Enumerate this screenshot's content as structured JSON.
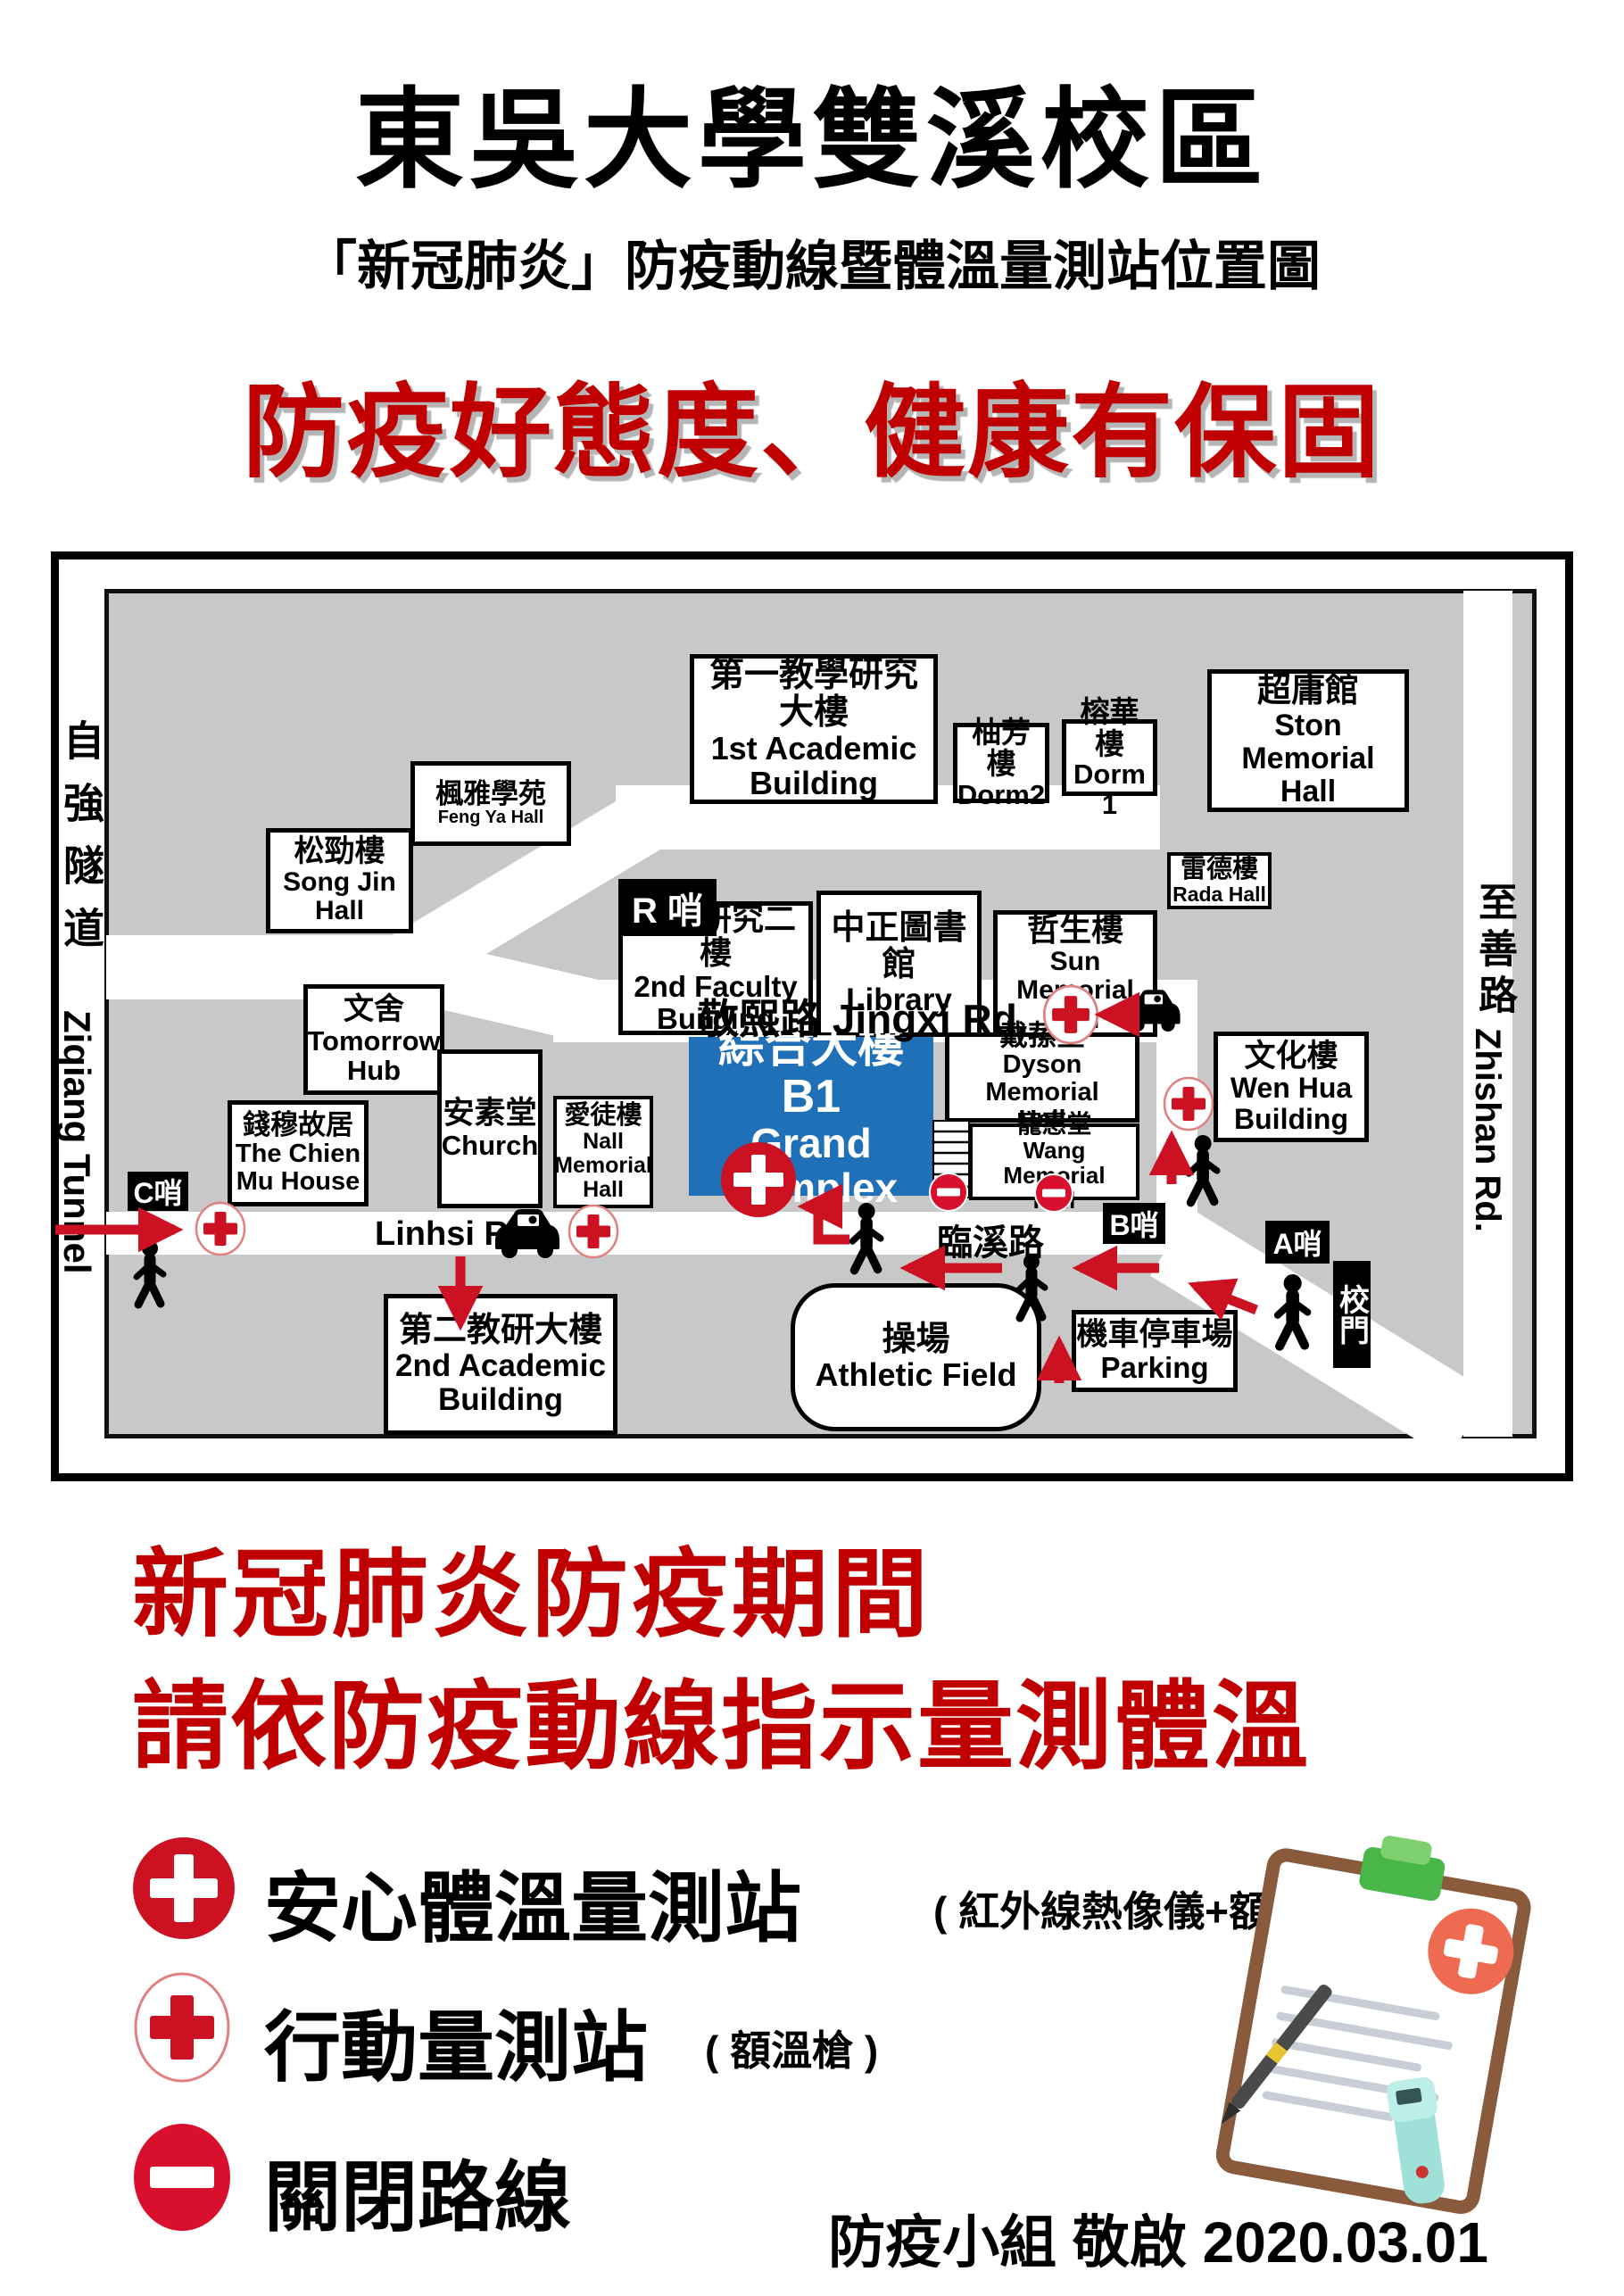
{
  "header": {
    "title": "東吳大學雙溪校區",
    "subtitle": "「新冠肺炎」防疫動線暨體溫量測站位置圖",
    "slogan": "防疫好態度、健康有保固"
  },
  "map": {
    "tunnel_zh": "自強隧道",
    "tunnel_en": "Ziqiang Tunnel",
    "zhishan_zh": "至善路",
    "zhishan_en": "Zhishan Rd.",
    "jingxi_label": "敬熙路 Jingxi Rd.",
    "linhsi_zh": "臨溪路",
    "linhsi_en": "Linhsi Rd.",
    "checkpoints": {
      "r": "R 哨",
      "c": "C哨",
      "b": "B哨",
      "a": "A哨",
      "gate": "校門"
    },
    "buildings": {
      "feng_ya": {
        "zh": "楓雅學苑",
        "en1": "Feng Ya Hall"
      },
      "song_jin": {
        "zh": "松勁樓",
        "en1": "Song Jin",
        "en2": "Hall"
      },
      "academic1": {
        "zh": "第一教學研究大樓",
        "en1": "1st Academic",
        "en2": "Building"
      },
      "dorm2": {
        "zh": "柚芳樓",
        "en1": "Dorm2"
      },
      "dorm1": {
        "zh": "榕華樓",
        "en1": "Dorm 1"
      },
      "ston": {
        "zh": "超庸館",
        "en1": "Ston Memorial",
        "en2": "Hall"
      },
      "faculty2": {
        "zh": "教師研究二樓",
        "en1": "2nd Faculty",
        "en2": "Building"
      },
      "library": {
        "zh": "中正圖書館",
        "en1": "Library"
      },
      "sun": {
        "zh": "哲生樓",
        "en1": "Sun Memorial",
        "en2": "Hall"
      },
      "rada": {
        "zh": "雷德樓",
        "en1": "Rada Hall"
      },
      "hub": {
        "zh": "文舍",
        "en1": "Tomorrow",
        "en2": "Hub"
      },
      "chien_mu": {
        "zh": "錢穆故居",
        "en1": "The Chien",
        "en2": "Mu House"
      },
      "church": {
        "zh": "安素堂",
        "en1": "Church"
      },
      "nall": {
        "zh": "愛徒樓",
        "en1": "Nall",
        "en2": "Memorial",
        "en3": "Hall"
      },
      "grand": {
        "zh": "綜合大樓 B1",
        "en1": "Grand Complex"
      },
      "dyson": {
        "zh": "戴蓀堂",
        "en1": "Dyson Memorial",
        "en2": "Hall"
      },
      "wang": {
        "zh": "寵惠堂",
        "en1": "Wang Memorial",
        "en2": "Hall"
      },
      "wen_hua": {
        "zh": "文化樓",
        "en1": "Wen Hua",
        "en2": "Building"
      },
      "academic2": {
        "zh": "第二教研大樓",
        "en1": "2nd Academic",
        "en2": "Building"
      },
      "athletic": {
        "zh": "操場",
        "en1": "Athletic Field"
      },
      "parking": {
        "zh": "機車停車場",
        "en1": "Parking"
      }
    }
  },
  "notice": {
    "line1": "新冠肺炎防疫期間",
    "line2": "請依防疫動線指示量測體溫"
  },
  "legend": {
    "safe_label": "安心體溫量測站",
    "safe_note": "( 紅外線熱像儀+額溫槍 )",
    "mobile_label": "行動量測站",
    "mobile_note": "( 額溫槍 )",
    "closed_label": "關閉路線"
  },
  "footer": "防疫小組 敬啟 2020.03.01",
  "colors": {
    "accent_red": "#cc1122",
    "text_red": "#c00000",
    "grand_complex_blue": "#2070b8",
    "map_gray": "#c8c8c8"
  }
}
